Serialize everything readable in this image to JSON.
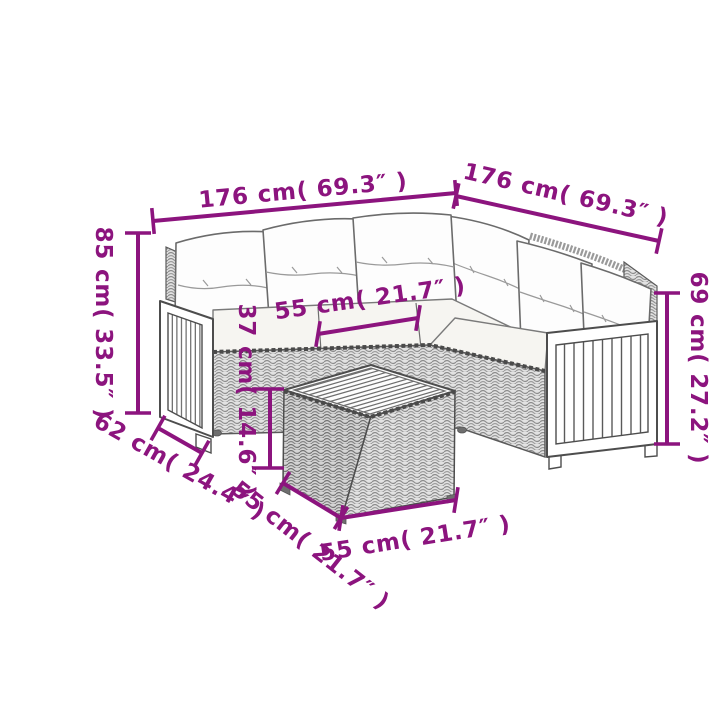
{
  "diagram": {
    "accent_color": "#8c147e",
    "dims": {
      "back_width_left": "176 cm( 69.3″ )",
      "back_width_right": "176 cm( 69.3″ )",
      "overall_height": "85 cm( 33.5″ )",
      "arm_side_height": "69 cm( 27.2″ )",
      "seat_cushion_width": "55 cm( 21.7″ )",
      "table_height": "37 cm( 14.6″ )",
      "seat_depth": "62 cm( 24.4″ )",
      "table_depth": "55 cm( 21.7″ )",
      "table_width": "55 cm( 21.7″ )"
    }
  }
}
